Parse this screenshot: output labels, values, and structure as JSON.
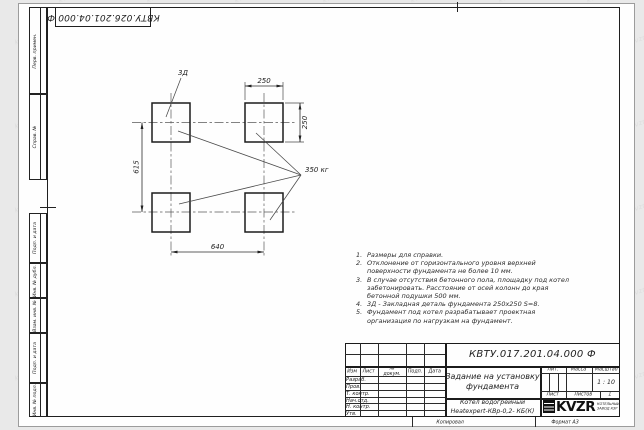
{
  "watermark": {
    "text": "kvzr.kz"
  },
  "stamps": {
    "top_designation": "КВТУ.026.201.04.000 Ф"
  },
  "margin_fields": {
    "top": [
      "Перв. примен.",
      "Справ. №"
    ],
    "bottom": [
      "Подп. и дата",
      "Инв. № дубл.",
      "Взам. инв. №",
      "Подп. и дата",
      "Инв. № подл."
    ]
  },
  "drawing": {
    "labels": {
      "detail": "3Д",
      "load": "350 кг",
      "dim_top": "250",
      "dim_right": "250",
      "dim_left": "615",
      "dim_bottom": "640"
    }
  },
  "notes": {
    "items": [
      {
        "num": "1.",
        "text": "Размеры для справки."
      },
      {
        "num": "2.",
        "text": "Отклонение от горизонтального уровня верхней поверхности фундамента не более 10 мм."
      },
      {
        "num": "3.",
        "text": "В случае отсутствия бетонного пола, площадку под котел забетонировать. Расстояние от осей колонн до края бетонной подушки 500 мм."
      },
      {
        "num": "4.",
        "text": "3Д - Закладная деталь фундамента 250х250 S=8."
      },
      {
        "num": "5.",
        "text": "Фундамент под котел разрабатывает проектная организация по нагрузкам на фундамент."
      }
    ]
  },
  "title_block": {
    "designation": "КВТУ.017.201.04.000 Ф",
    "doc_title": "Задание на установку фундамента",
    "product_line1": "Котел водогрейный",
    "product_line2": "Heatexpert-КВр-0,2- КБ(К)",
    "header_cols": [
      "Изм",
      "Лист",
      "№ докум.",
      "Подп.",
      "Дата"
    ],
    "rows": [
      "Разраб.",
      "Пров.",
      "Т. контр.",
      "Нач.отд.",
      "Н. контр.",
      "Утв."
    ],
    "lit_label": "Лит.",
    "mass_label": "Масса",
    "scale_label": "Масштаб",
    "scale_value": "1 : 10",
    "sheet_label": "Лист",
    "sheets_label": "Листов",
    "sheets_value": "1",
    "logo_text": "KVZR",
    "logo_caption1": "КОТЕЛЬНЫЙ",
    "logo_caption2": "ЗАВОД КЗР",
    "copied_label": "Копировал",
    "format_label": "Формат А3"
  }
}
